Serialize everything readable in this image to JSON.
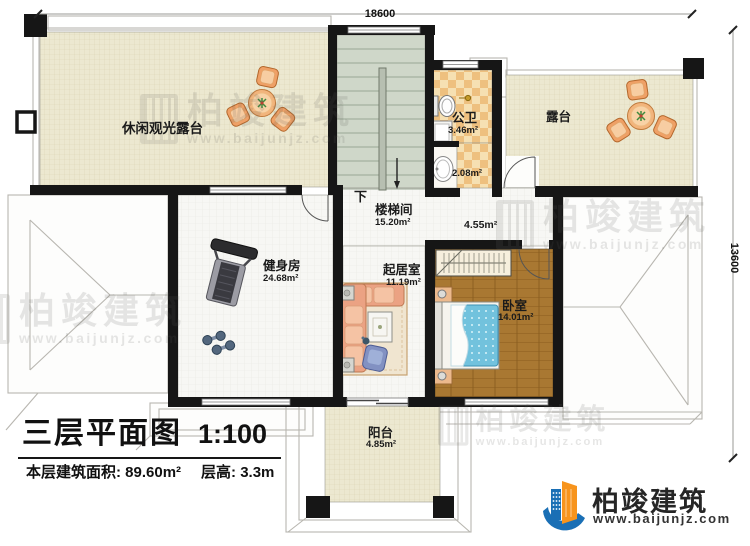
{
  "dimensions": {
    "top": "18600",
    "right": "13600"
  },
  "rooms": {
    "leisure_terrace": {
      "name": "休闲观光露台"
    },
    "terrace": {
      "name": "露台"
    },
    "public_bath": {
      "name": "公卫",
      "area": "3.46m²"
    },
    "bath_vanity": {
      "area": "2.08m²"
    },
    "stairwell": {
      "name": "楼梯间",
      "area": "15.20m²",
      "down": "下"
    },
    "corridor": {
      "area": "4.55m²"
    },
    "gym": {
      "name": "健身房",
      "area": "24.68m²"
    },
    "living": {
      "name": "起居室",
      "area": "11.19m²"
    },
    "bedroom": {
      "name": "卧室",
      "area": "14.01m²"
    },
    "balcony": {
      "name": "阳台",
      "area": "4.85m²"
    }
  },
  "title_block": {
    "title": "三层平面图",
    "scale": "1:100",
    "area_text": "本层建筑面积: 89.60m²",
    "height_text": "层高: 3.3m"
  },
  "brand": {
    "name": "柏竣建筑",
    "url": "www.baijunjz.com",
    "blue": "#1a6fb5",
    "orange": "#f7941d"
  }
}
